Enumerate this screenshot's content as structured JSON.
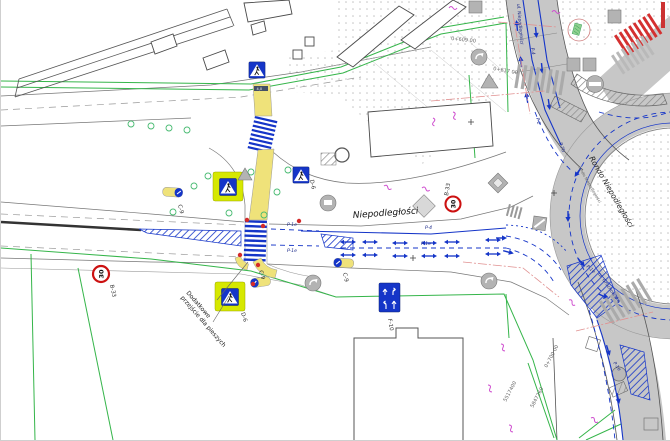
{
  "drawing": {
    "streets": {
      "main": "Niepodległości",
      "roundabout": "Rondo Niepodległości",
      "roundabout_small": "rondo Niepodległości",
      "north_approach": "ul. Niepodległości",
      "southeast_exit": "ul. Grochowska"
    },
    "signs": {
      "speed_limit": "30",
      "speed_limit_code": "B-33",
      "pedestrian_crossing_code": "D-6",
      "keep_right_code": "C-9",
      "lane_directions_code": "F-10"
    },
    "markings": {
      "p4": "P-4",
      "p1e": "P-1e",
      "p2": "P-2",
      "p7b": "P-7b"
    },
    "notes": {
      "additional_crossing_line1": "Dodatkowe",
      "additional_crossing_line2": "przejście dla pieszych",
      "width_label": "4,0"
    },
    "chainage": {
      "top": "0+609 00",
      "mid": "0+617 00",
      "bottom": "0+700 00"
    },
    "coordinates": {
      "easting": "5517400",
      "northing": "5847260"
    },
    "colors": {
      "marking_blue": "#1535c8",
      "sign_red": "#cc1111",
      "highlight_yellow": "#d6e800",
      "path_yellow": "#efe27a",
      "boundary_green": "#35b54a",
      "road_gray": "#c7c7c7",
      "accent_magenta": "#cf4fcf",
      "crosswalk_red": "#d43030"
    }
  }
}
